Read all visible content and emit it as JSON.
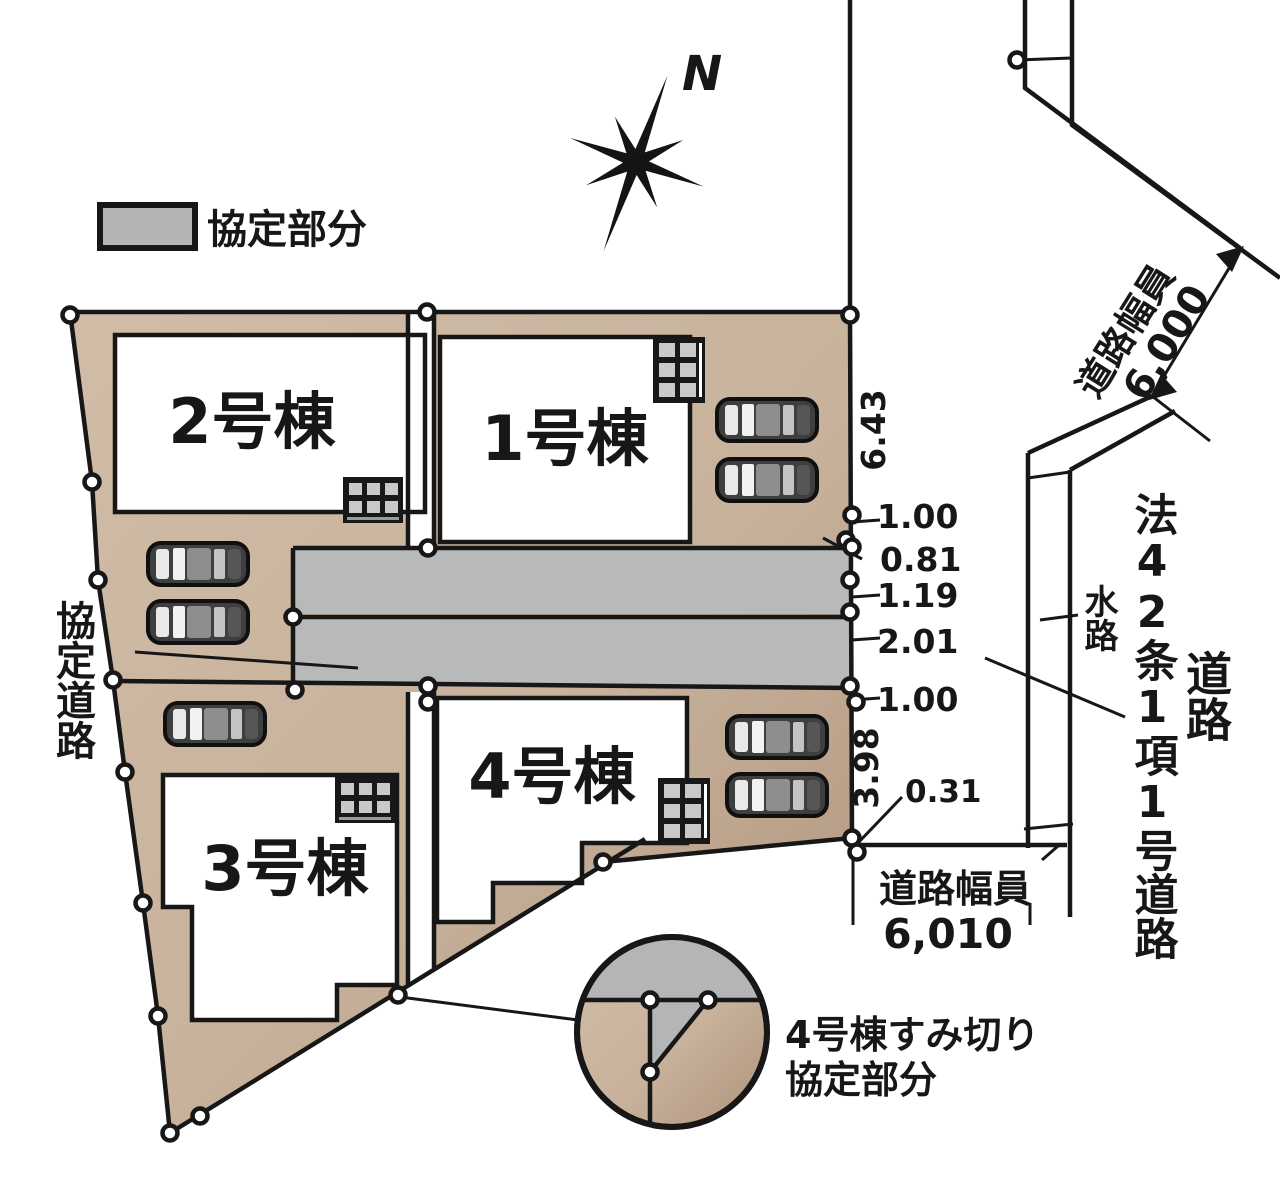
{
  "colors": {
    "lot_fill": "#c8b29c",
    "lot_fill_dark": "#b1987e",
    "road_fill": "#b7bab8",
    "legend_gray": "#b4b4b4",
    "line": "#171717",
    "background": "#ffffff"
  },
  "legend": {
    "agreement_label": "協定部分"
  },
  "compass": {
    "north_label": "N"
  },
  "buildings": {
    "b1_label": "1号棟",
    "b2_label": "2号棟",
    "b3_label": "3号棟",
    "b4_label": "4号棟"
  },
  "dims": {
    "d_643": "6.43",
    "d_100a": "1.00",
    "d_081": "0.81",
    "d_119": "1.19",
    "d_201": "2.01",
    "d_100b": "1.00",
    "d_398": "3.98",
    "d_031": "0.31"
  },
  "roads": {
    "top_width_label": "道路幅員",
    "top_width_value": "6,000",
    "bottom_width_label": "道路幅員",
    "bottom_width_value": "6,010",
    "law_road_label": "法42条1項1号道路",
    "road_label": "道路",
    "waterway_label": "水路",
    "agreement_road_label": "協定道路"
  },
  "detail_callout": {
    "line1": "4号棟すみ切り",
    "line2": "協定部分"
  }
}
